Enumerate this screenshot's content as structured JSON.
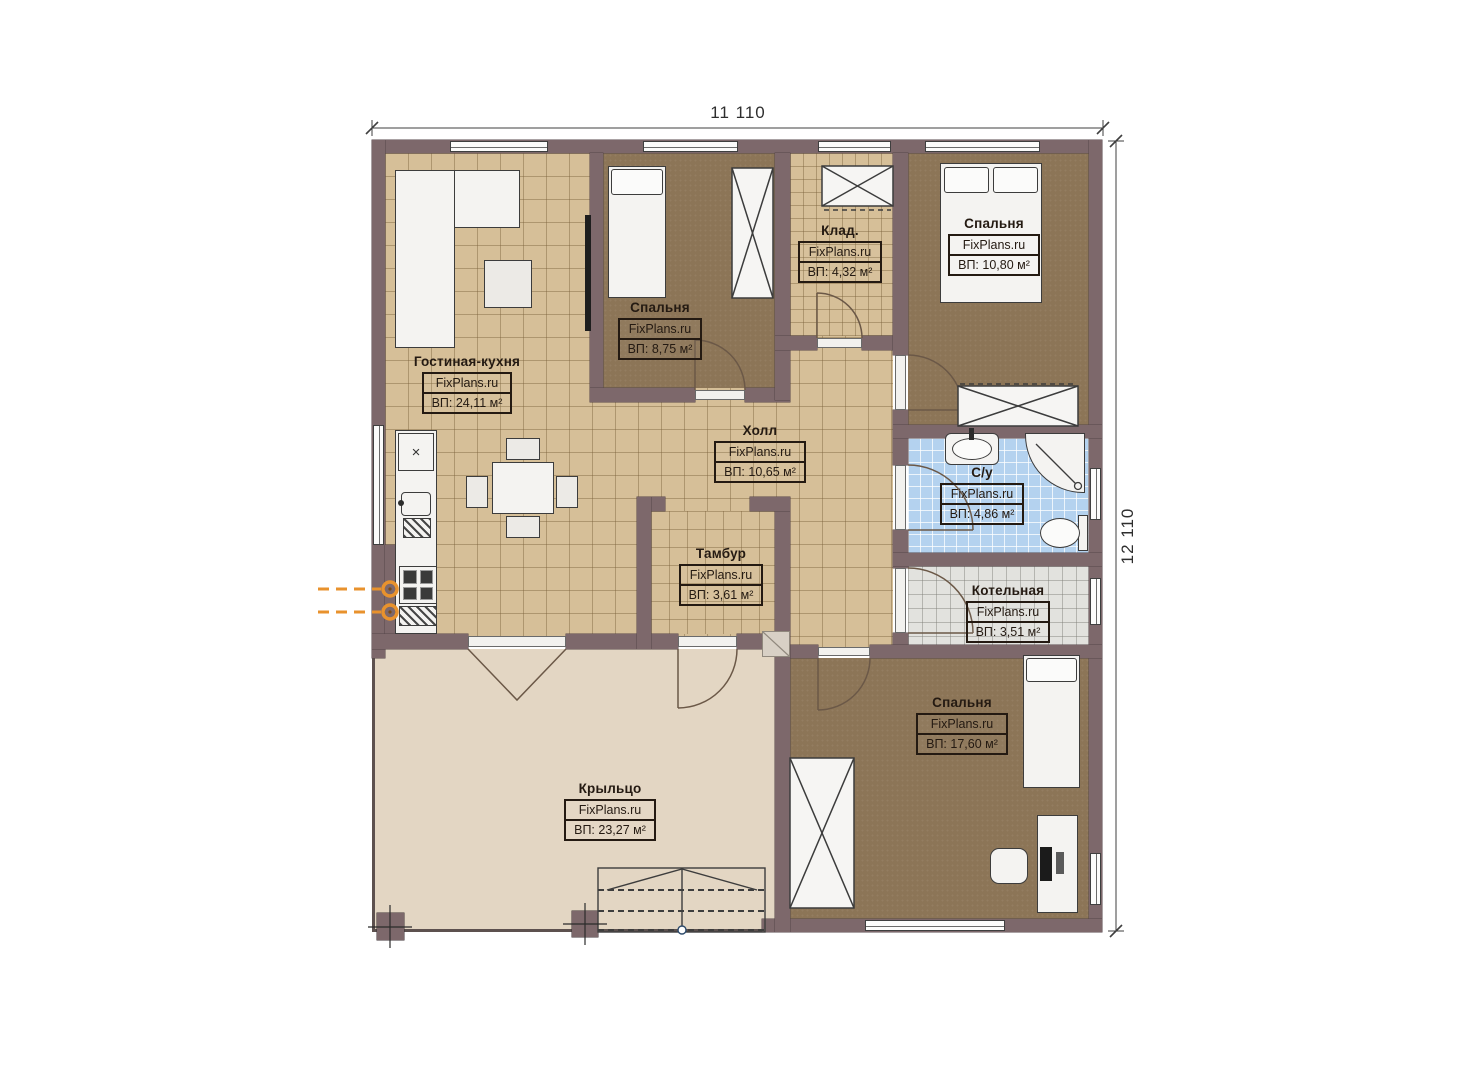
{
  "plan": {
    "dimensions": {
      "width_label": "11 110",
      "height_label": "12 110"
    },
    "icons": {
      "cabinet_cross": "×"
    },
    "colors": {
      "wall": "#7d686b",
      "tile_beige": "#d6bf98",
      "carpet_brown": "#8c7557",
      "tile_blue": "#b4d2ef",
      "tile_gray": "#e2e2de",
      "porch": "#e3d6c3",
      "gas_orange": "#e8922d",
      "label_ink": "#241a12"
    },
    "rooms": [
      {
        "id": "living-kitchen",
        "name": "Гостиная-кухня",
        "brand": "FixPlans.ru",
        "area": "ВП: 24,11 м²"
      },
      {
        "id": "bedroom-1",
        "name": "Спальня",
        "brand": "FixPlans.ru",
        "area": "ВП: 8,75 м²"
      },
      {
        "id": "storage",
        "name": "Клад.",
        "brand": "FixPlans.ru",
        "area": "ВП: 4,32 м²"
      },
      {
        "id": "bedroom-2",
        "name": "Спальня",
        "brand": "FixPlans.ru",
        "area": "ВП: 10,80 м²"
      },
      {
        "id": "hall",
        "name": "Холл",
        "brand": "FixPlans.ru",
        "area": "ВП: 10,65 м²"
      },
      {
        "id": "bathroom",
        "name": "С/у",
        "brand": "FixPlans.ru",
        "area": "ВП: 4,86 м²"
      },
      {
        "id": "vestibule",
        "name": "Тамбур",
        "brand": "FixPlans.ru",
        "area": "ВП: 3,61 м²"
      },
      {
        "id": "boiler-room",
        "name": "Котельная",
        "brand": "FixPlans.ru",
        "area": "ВП: 3,51 м²"
      },
      {
        "id": "bedroom-3",
        "name": "Спальня",
        "brand": "FixPlans.ru",
        "area": "ВП: 17,60 м²"
      },
      {
        "id": "porch",
        "name": "Крыльцо",
        "brand": "FixPlans.ru",
        "area": "ВП: 23,27 м²"
      }
    ]
  }
}
